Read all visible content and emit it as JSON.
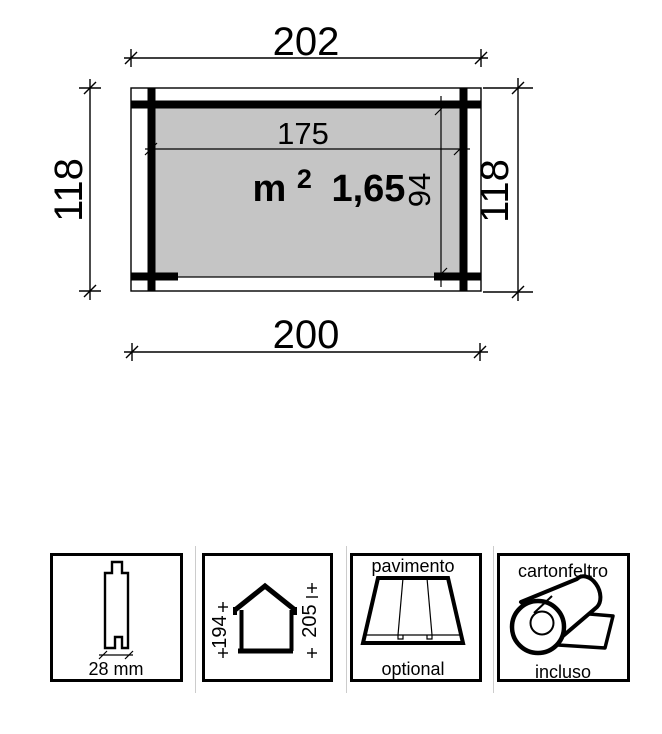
{
  "plan": {
    "width_overall": "202",
    "width_base": "200",
    "depth_left": "118",
    "depth_right": "118",
    "width_inner": "175",
    "depth_inner": "94",
    "area_unit": "m",
    "area_exponent": "2",
    "area_value": "1,65"
  },
  "features": {
    "plank": {
      "thickness": "28 mm"
    },
    "house": {
      "eaves_height": "194",
      "ridge_height": "205"
    },
    "floor": {
      "title": "pavimento",
      "note": "optional"
    },
    "felt": {
      "title": "cartonfeltro",
      "note": "incluso"
    }
  },
  "colors": {
    "line": "#000000",
    "interior_fill": "#c5c5c5",
    "separator": "#cccccc",
    "background": "#ffffff"
  }
}
